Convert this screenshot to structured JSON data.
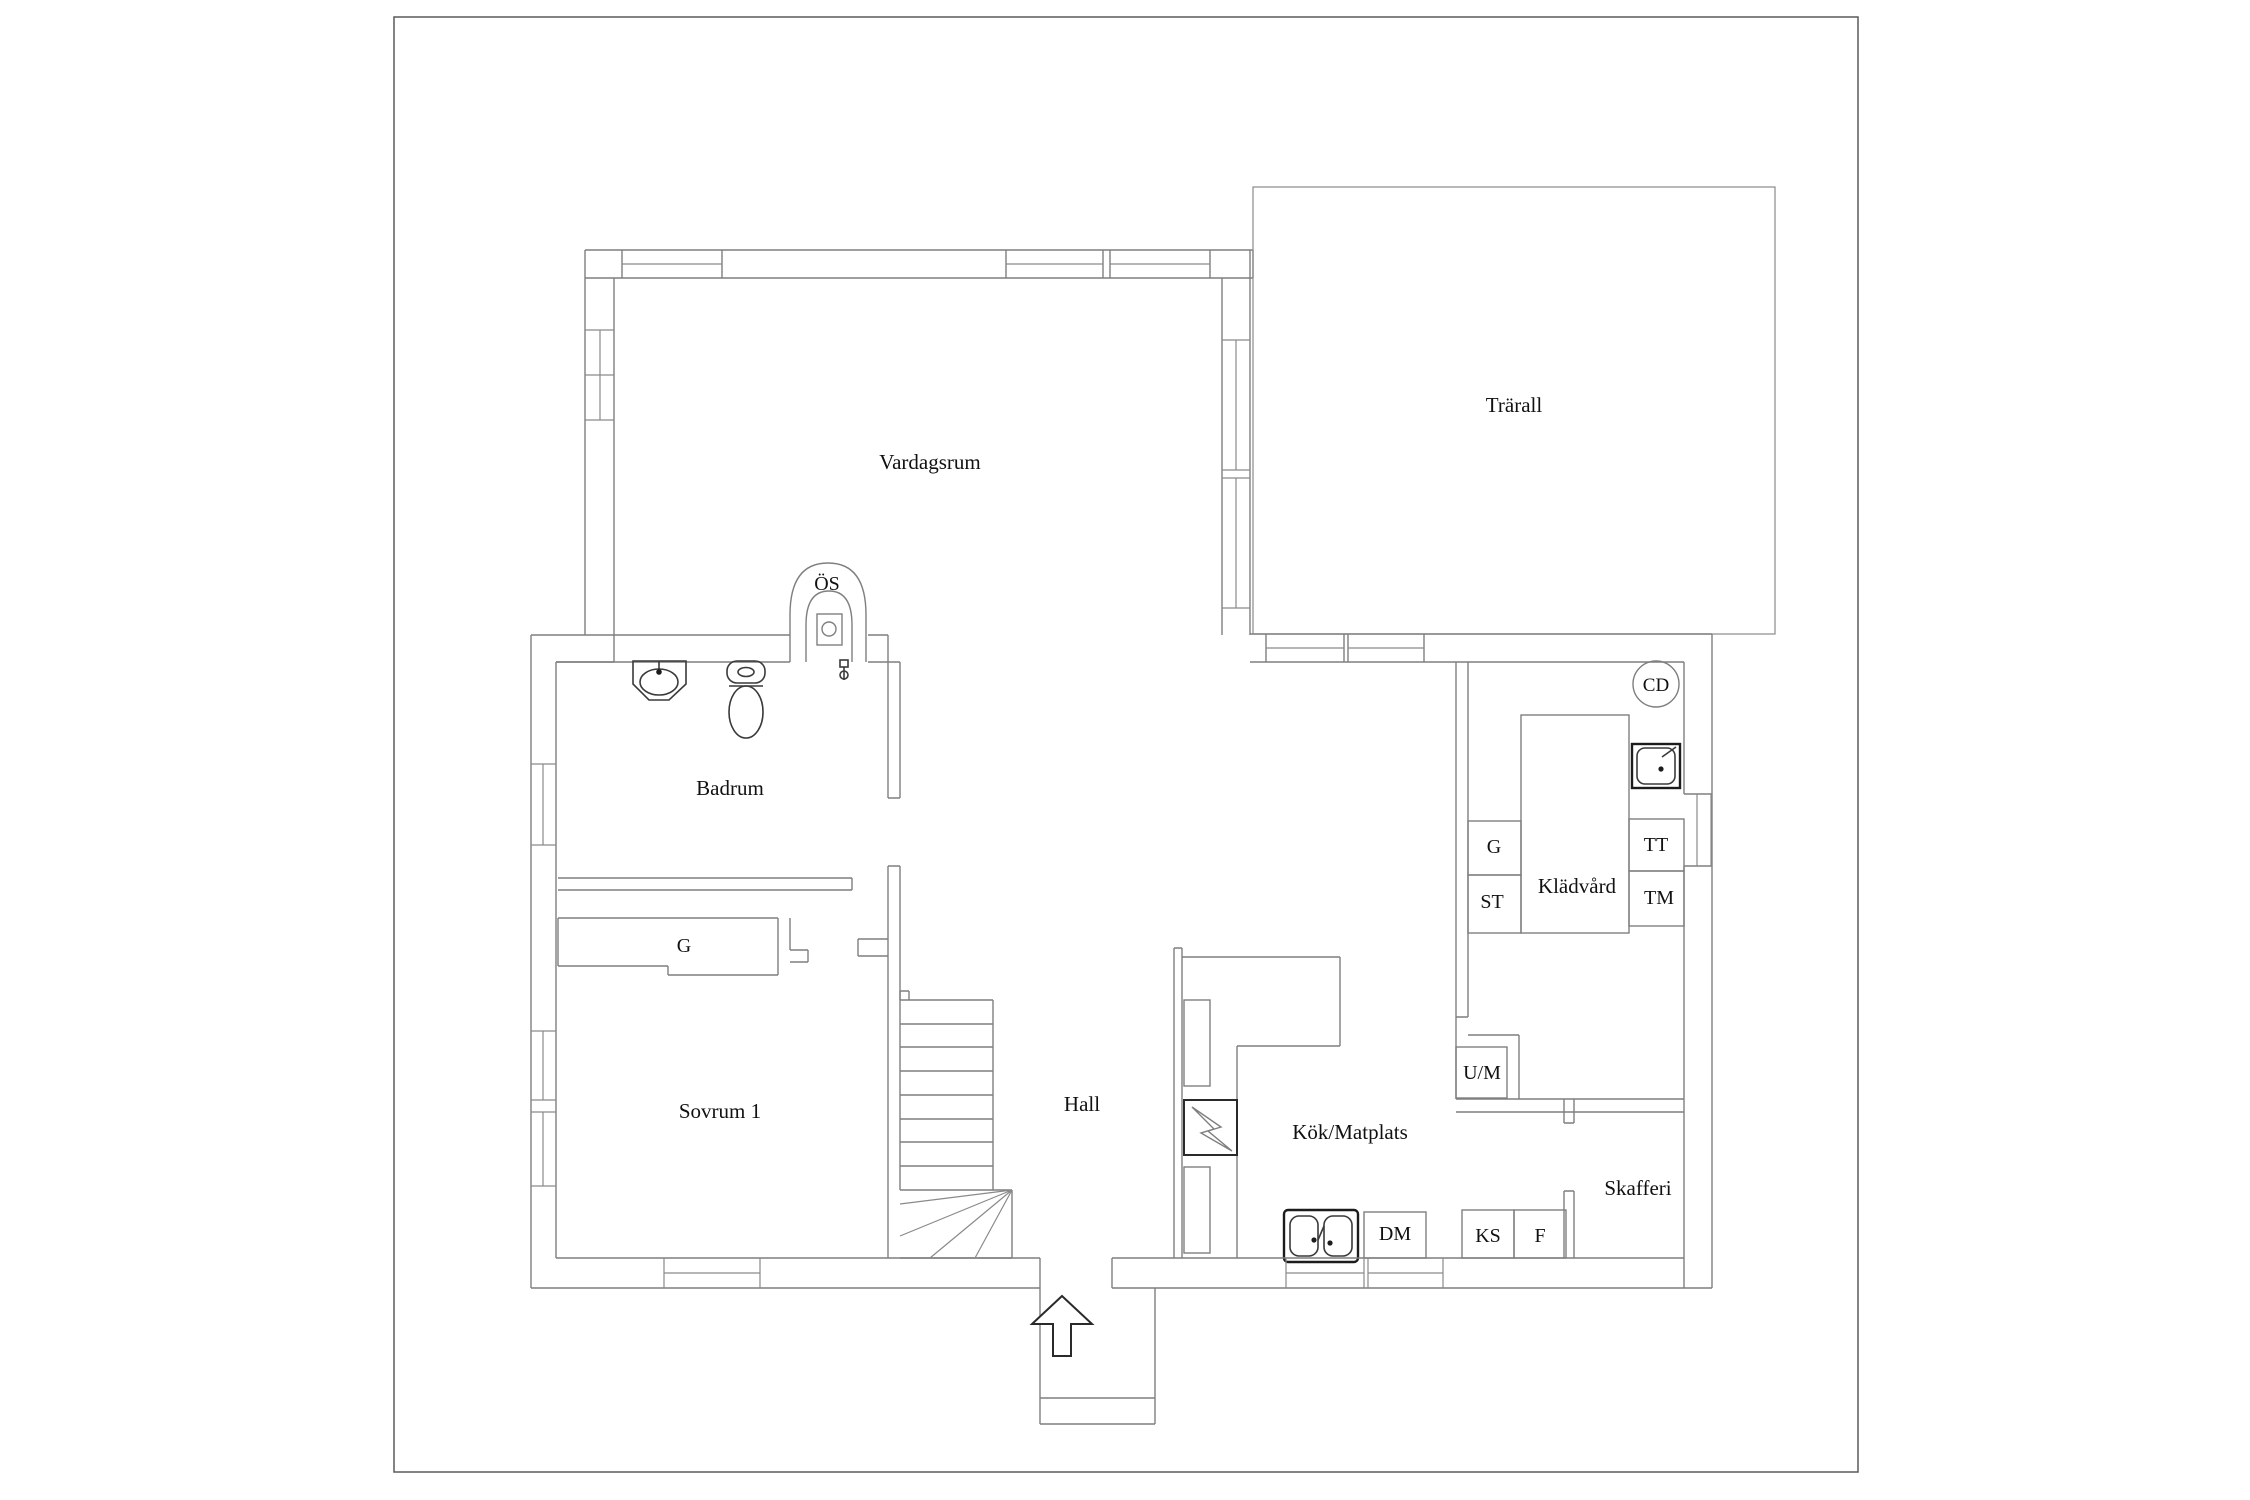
{
  "rooms": {
    "vardagsrum": {
      "label": "Vardagsrum"
    },
    "trarall": {
      "label": "Trärall"
    },
    "badrum": {
      "label": "Badrum"
    },
    "sovrum1": {
      "label": "Sovrum 1"
    },
    "hall": {
      "label": "Hall"
    },
    "kok": {
      "label": "Kök/Matplats"
    },
    "kladvard": {
      "label": "Klädvård"
    },
    "skafferi": {
      "label": "Skafferi"
    }
  },
  "fixture_labels": {
    "os": "ÖS",
    "cd": "CD",
    "g_sovrum": "G",
    "g_kladvard": "G",
    "st": "ST",
    "tt": "TT",
    "tm": "TM",
    "um": "U/M",
    "dm": "DM",
    "ks": "KS",
    "f": "F"
  },
  "colors": {
    "background": "#ffffff",
    "wall_line": "#7f7f7f",
    "bold_fixture_line": "#1c1c1c",
    "text": "#111111",
    "page_border": "#5a5a5a"
  }
}
